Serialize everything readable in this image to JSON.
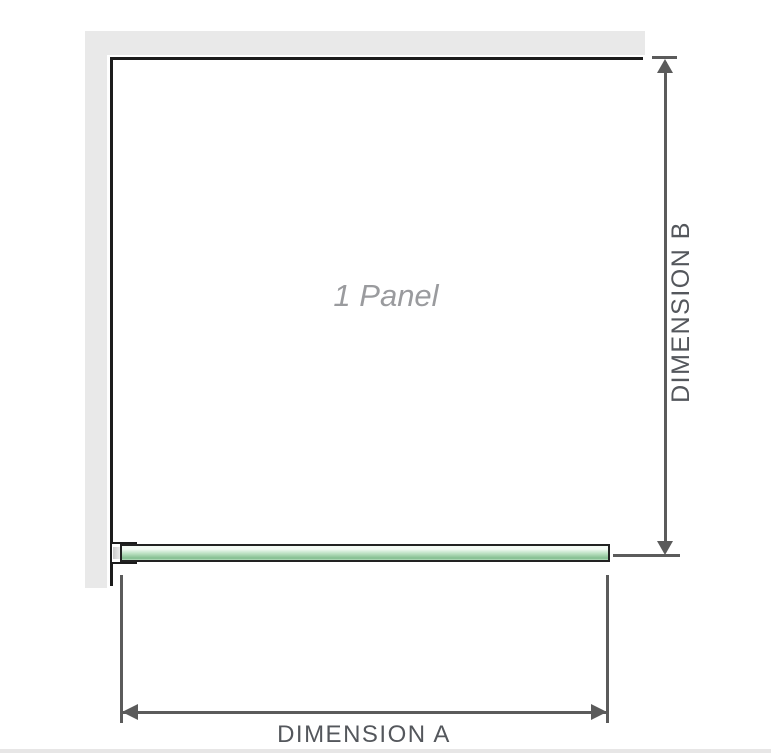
{
  "diagram": {
    "panel_label": "1 Panel",
    "dimension_a": {
      "label": "DIMENSION A"
    },
    "dimension_b": {
      "label": "DIMENSION B"
    }
  },
  "colors": {
    "wall": "#e9e9e9",
    "panel_border": "#1c1c1c",
    "glass_border": "#222222",
    "glass_light": "#f3faf4",
    "glass_mid": "#b9e0c0",
    "glass_dark": "#82bd8f",
    "clamp_shade": "#c9c9c9",
    "dimension_line": "#5b5b5b",
    "dimension_label": "#54575c",
    "panel_label_color": "#9a9b9e",
    "footer_divider": "#e7e6e6"
  }
}
